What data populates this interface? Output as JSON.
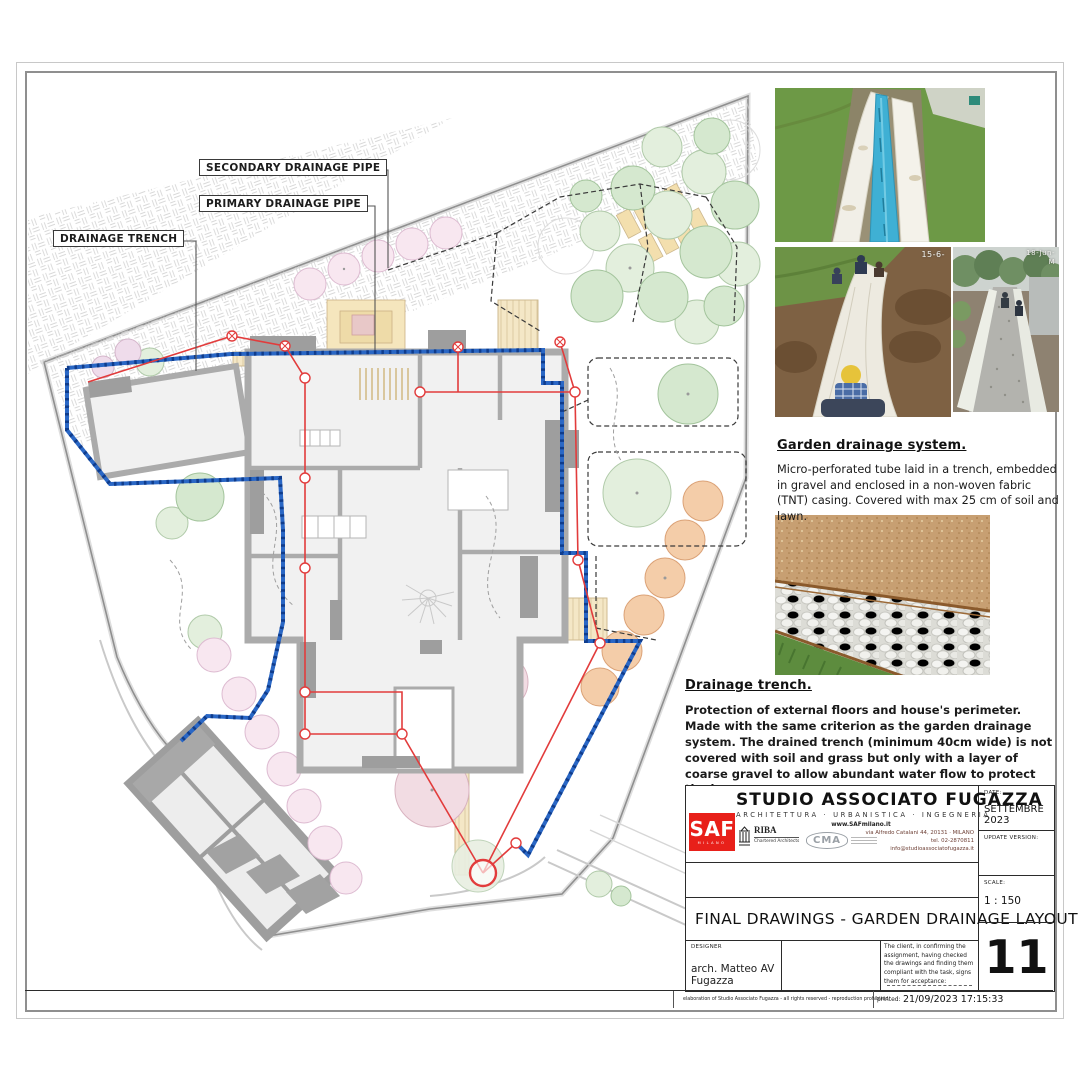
{
  "plan": {
    "label_secondary": "SECONDARY DRAINAGE PIPE",
    "label_primary": "PRIMARY DRAINAGE PIPE",
    "label_trench": "DRAINAGE TRENCH"
  },
  "photos": {
    "ts2": "15-6-",
    "ts3a": "18-Jun-",
    "ts3b": "M"
  },
  "sections": {
    "garden": {
      "heading": "Garden drainage system.",
      "body": "Micro-perforated tube laid in a trench, embedded in gravel and enclosed in a non-woven fabric (TNT) casing. Covered with max 25 cm of soil and lawn."
    },
    "trench": {
      "heading": "Drainage trench.",
      "body1": "Protection of external floors and house's perimeter.",
      "body2": "Made with the same criterion as the garden drainage system. The drained trench (minimum 40cm wide) is not covered with soil and grass but only with a layer of coarse gravel to allow abundant water flow to protect the house."
    }
  },
  "titleblock": {
    "studio_name": "STUDIO ASSOCIATO FUGAZZA",
    "studio_subtitle": "ARCHITETTURA · URBANISTICA · INGEGNERIA",
    "website": "www.SAFmilano.it",
    "address": "via Alfredo Catalani 44, 20131 · MILANO",
    "phone": "tel. 02-2870811",
    "email": "info@studioassociatofugazza.it",
    "logo_saf": "SAF",
    "logo_saf_sub": "MILANO",
    "logo_riba": "RIBA",
    "logo_riba_sub": "Chartered Architects",
    "logo_cma": "CMA",
    "date_label": "DATE:",
    "date_value": "SETTEMBRE 2023",
    "update_label": "UPDATE VERSION:",
    "scale_label": "SCALE:",
    "scale_value": "1 : 150",
    "drawing_title": "FINAL DRAWINGS - GARDEN DRAINAGE LAYOUT",
    "designer_label": "DESIGNER",
    "designer_value": "arch. Matteo AV Fugazza",
    "acceptance_text": "The client, in confirming the assignment, having checked the drawings and finding them compliant with the task, signs them for acceptance:",
    "sheet_number": "11"
  },
  "footer": {
    "copyright": "elaboration of Studio Associato Fugazza - all rights reserved - reproduction prohibited",
    "printed_label": "printed:",
    "printed_value": "21/09/2023 17:15:33"
  }
}
